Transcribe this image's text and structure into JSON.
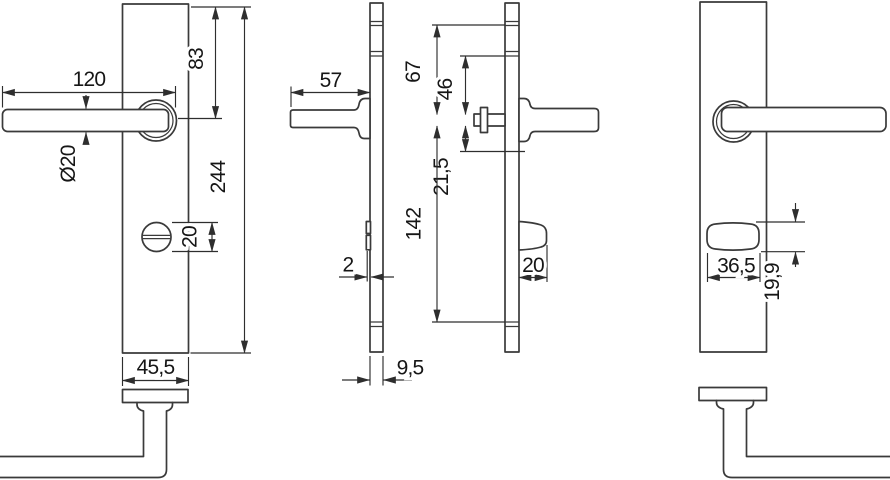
{
  "drawing": {
    "type": "technical-dimension-drawing",
    "subject": "security-door-fitting-lever-handle-on-long-backplate",
    "line_color": "#3a3a3a",
    "background": "#ffffff",
    "views": {
      "front_interior": {
        "dims": {
          "handle_length": "120",
          "top_to_handle_axis": "83",
          "handle_diameter": "Ø20",
          "plate_height": "244",
          "turn_knob_diameter": "20",
          "plate_width": "45,5"
        }
      },
      "profile_interior": {
        "dims": {
          "handle_projection": "57",
          "collar_offset": "2",
          "plate_depth": "9,5"
        }
      },
      "profile_exterior": {
        "dims": {
          "top_to_axis": "67",
          "groove_to_axis": "46",
          "axis_to_line": "21,5",
          "axis_to_bottom_groove": "142",
          "knob_projection": "20"
        }
      },
      "front_exterior": {
        "dims": {
          "cylinder_cover_width": "36,5",
          "cylinder_cover_height": "19,9"
        }
      }
    }
  }
}
